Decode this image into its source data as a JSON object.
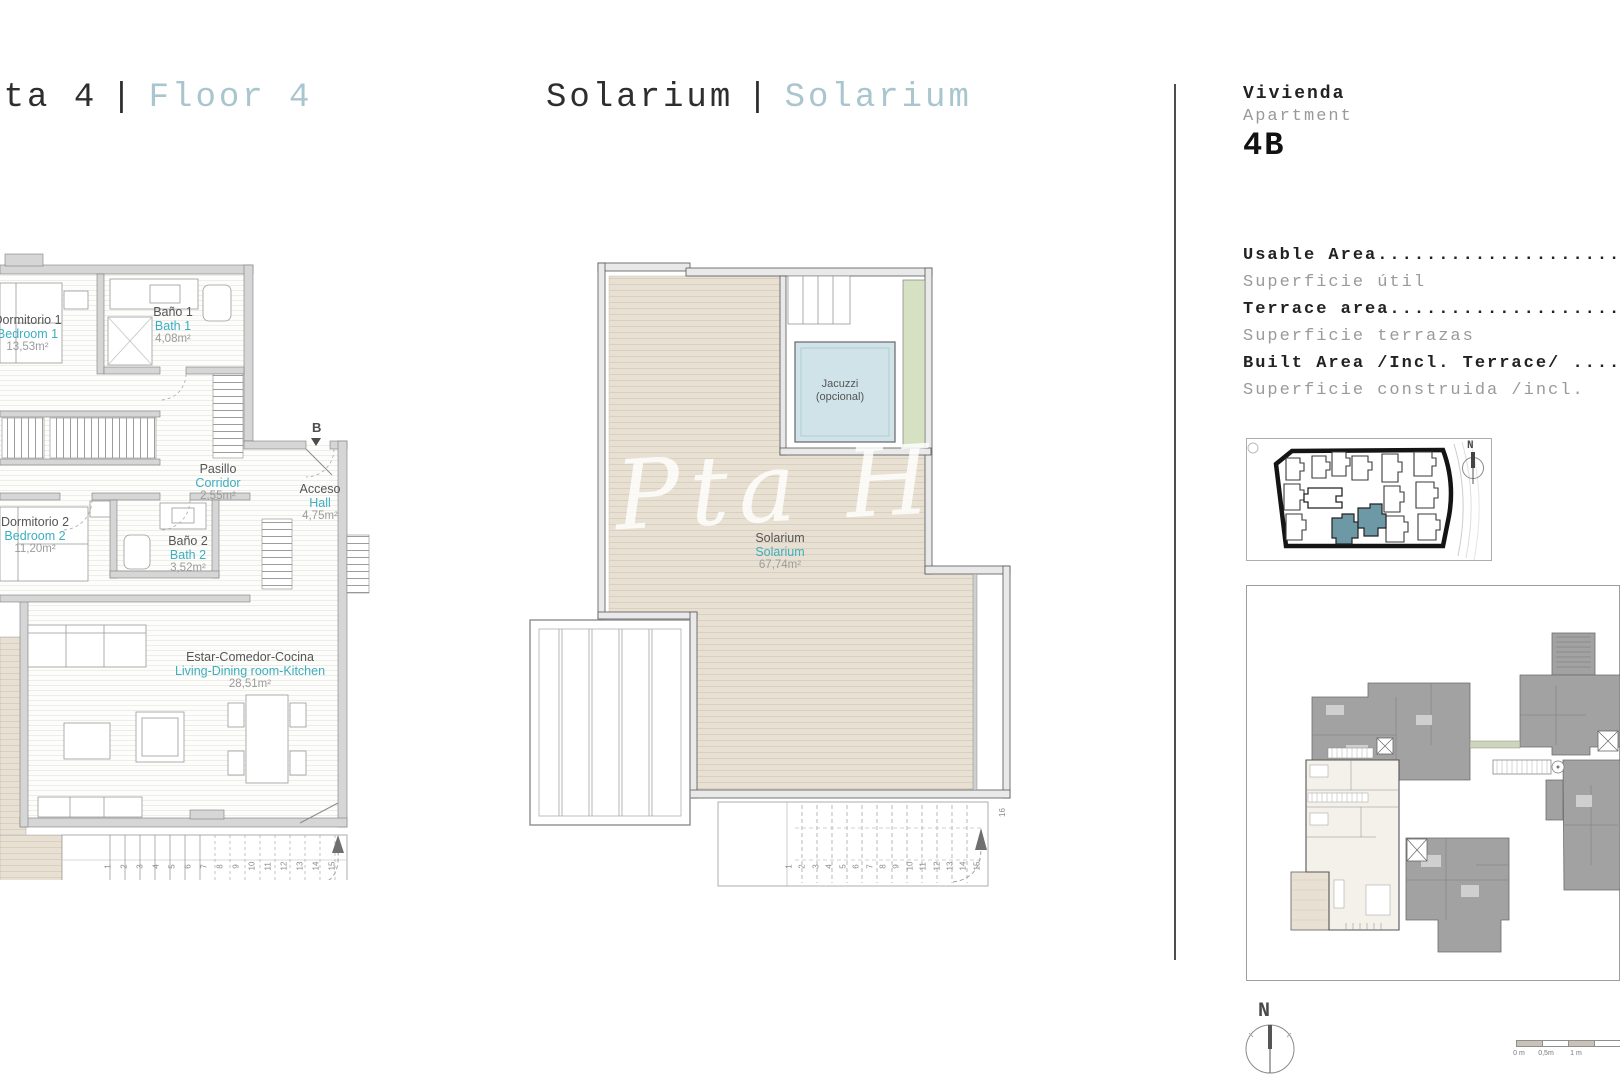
{
  "headers": {
    "plan1": {
      "es": "Planta 4",
      "sep": "|",
      "en": "Floor 4"
    },
    "plan2": {
      "es": "Solarium",
      "sep": "|",
      "en": "Solarium"
    }
  },
  "apartment": {
    "label_es": "Vivienda",
    "label_en": "Apartment",
    "unit": "4B"
  },
  "areas": [
    {
      "en": "Usable Area............................",
      "es": "Superficie útil"
    },
    {
      "en": "Terrace area...........................",
      "es": "Superficie terrazas"
    },
    {
      "en": "Built Area /Incl. Terrace/ ............",
      "es": "Superficie construida /incl. "
    }
  ],
  "plan1": {
    "rooms": [
      {
        "es": "Dormitorio 1",
        "en": "Bedroom 1",
        "area": "13,53m²"
      },
      {
        "es": "Baño 1",
        "en": "Bath 1",
        "area": "4,08m²"
      },
      {
        "es": "Pasillo",
        "en": "Corridor",
        "area": "2,55m²"
      },
      {
        "es": "Acceso",
        "en": "Hall",
        "area": "4,75m²"
      },
      {
        "es": "Dormitorio 2",
        "en": "Bedroom 2",
        "area": "11,20m²"
      },
      {
        "es": "Baño 2",
        "en": "Bath 2",
        "area": "3,52m²"
      },
      {
        "es": "Estar-Comedor-Cocina",
        "en": "Living-Dining room-Kitchen",
        "area": "28,51m²"
      }
    ],
    "section_marker": "B",
    "stair_numbers": [
      "1",
      "2",
      "3",
      "4",
      "5",
      "6",
      "7",
      "8",
      "9",
      "10",
      "11",
      "12",
      "13",
      "14",
      "15"
    ]
  },
  "plan2": {
    "jacuzzi": {
      "line1": "Jacuzzi",
      "line2": "(opcional)"
    },
    "room": {
      "es": "Solarium",
      "en": "Solarium",
      "area": "67,74m²"
    },
    "stair_numbers": [
      "1",
      "2",
      "3",
      "4",
      "5",
      "6",
      "7",
      "8",
      "9",
      "10",
      "11",
      "12",
      "13",
      "14",
      "15"
    ],
    "stair_last": "16",
    "watermark": "Pta Ho"
  },
  "minimap": {
    "north_label": "N"
  },
  "compass": {
    "north_label": "N"
  },
  "scalebar": {
    "labels": [
      "0 m",
      "0,5m",
      "1 m"
    ]
  },
  "colors": {
    "teal_text": "#3bafc0",
    "header_light": "#a9c6cf",
    "deck": "#e8e1d3",
    "jacuzzi": "#cfe3e9",
    "planter": "#d6e1c4",
    "teal_building": "#6d99a6",
    "wall_gray": "#d6d6d6",
    "keyplan_gray": "#a2a2a2"
  }
}
